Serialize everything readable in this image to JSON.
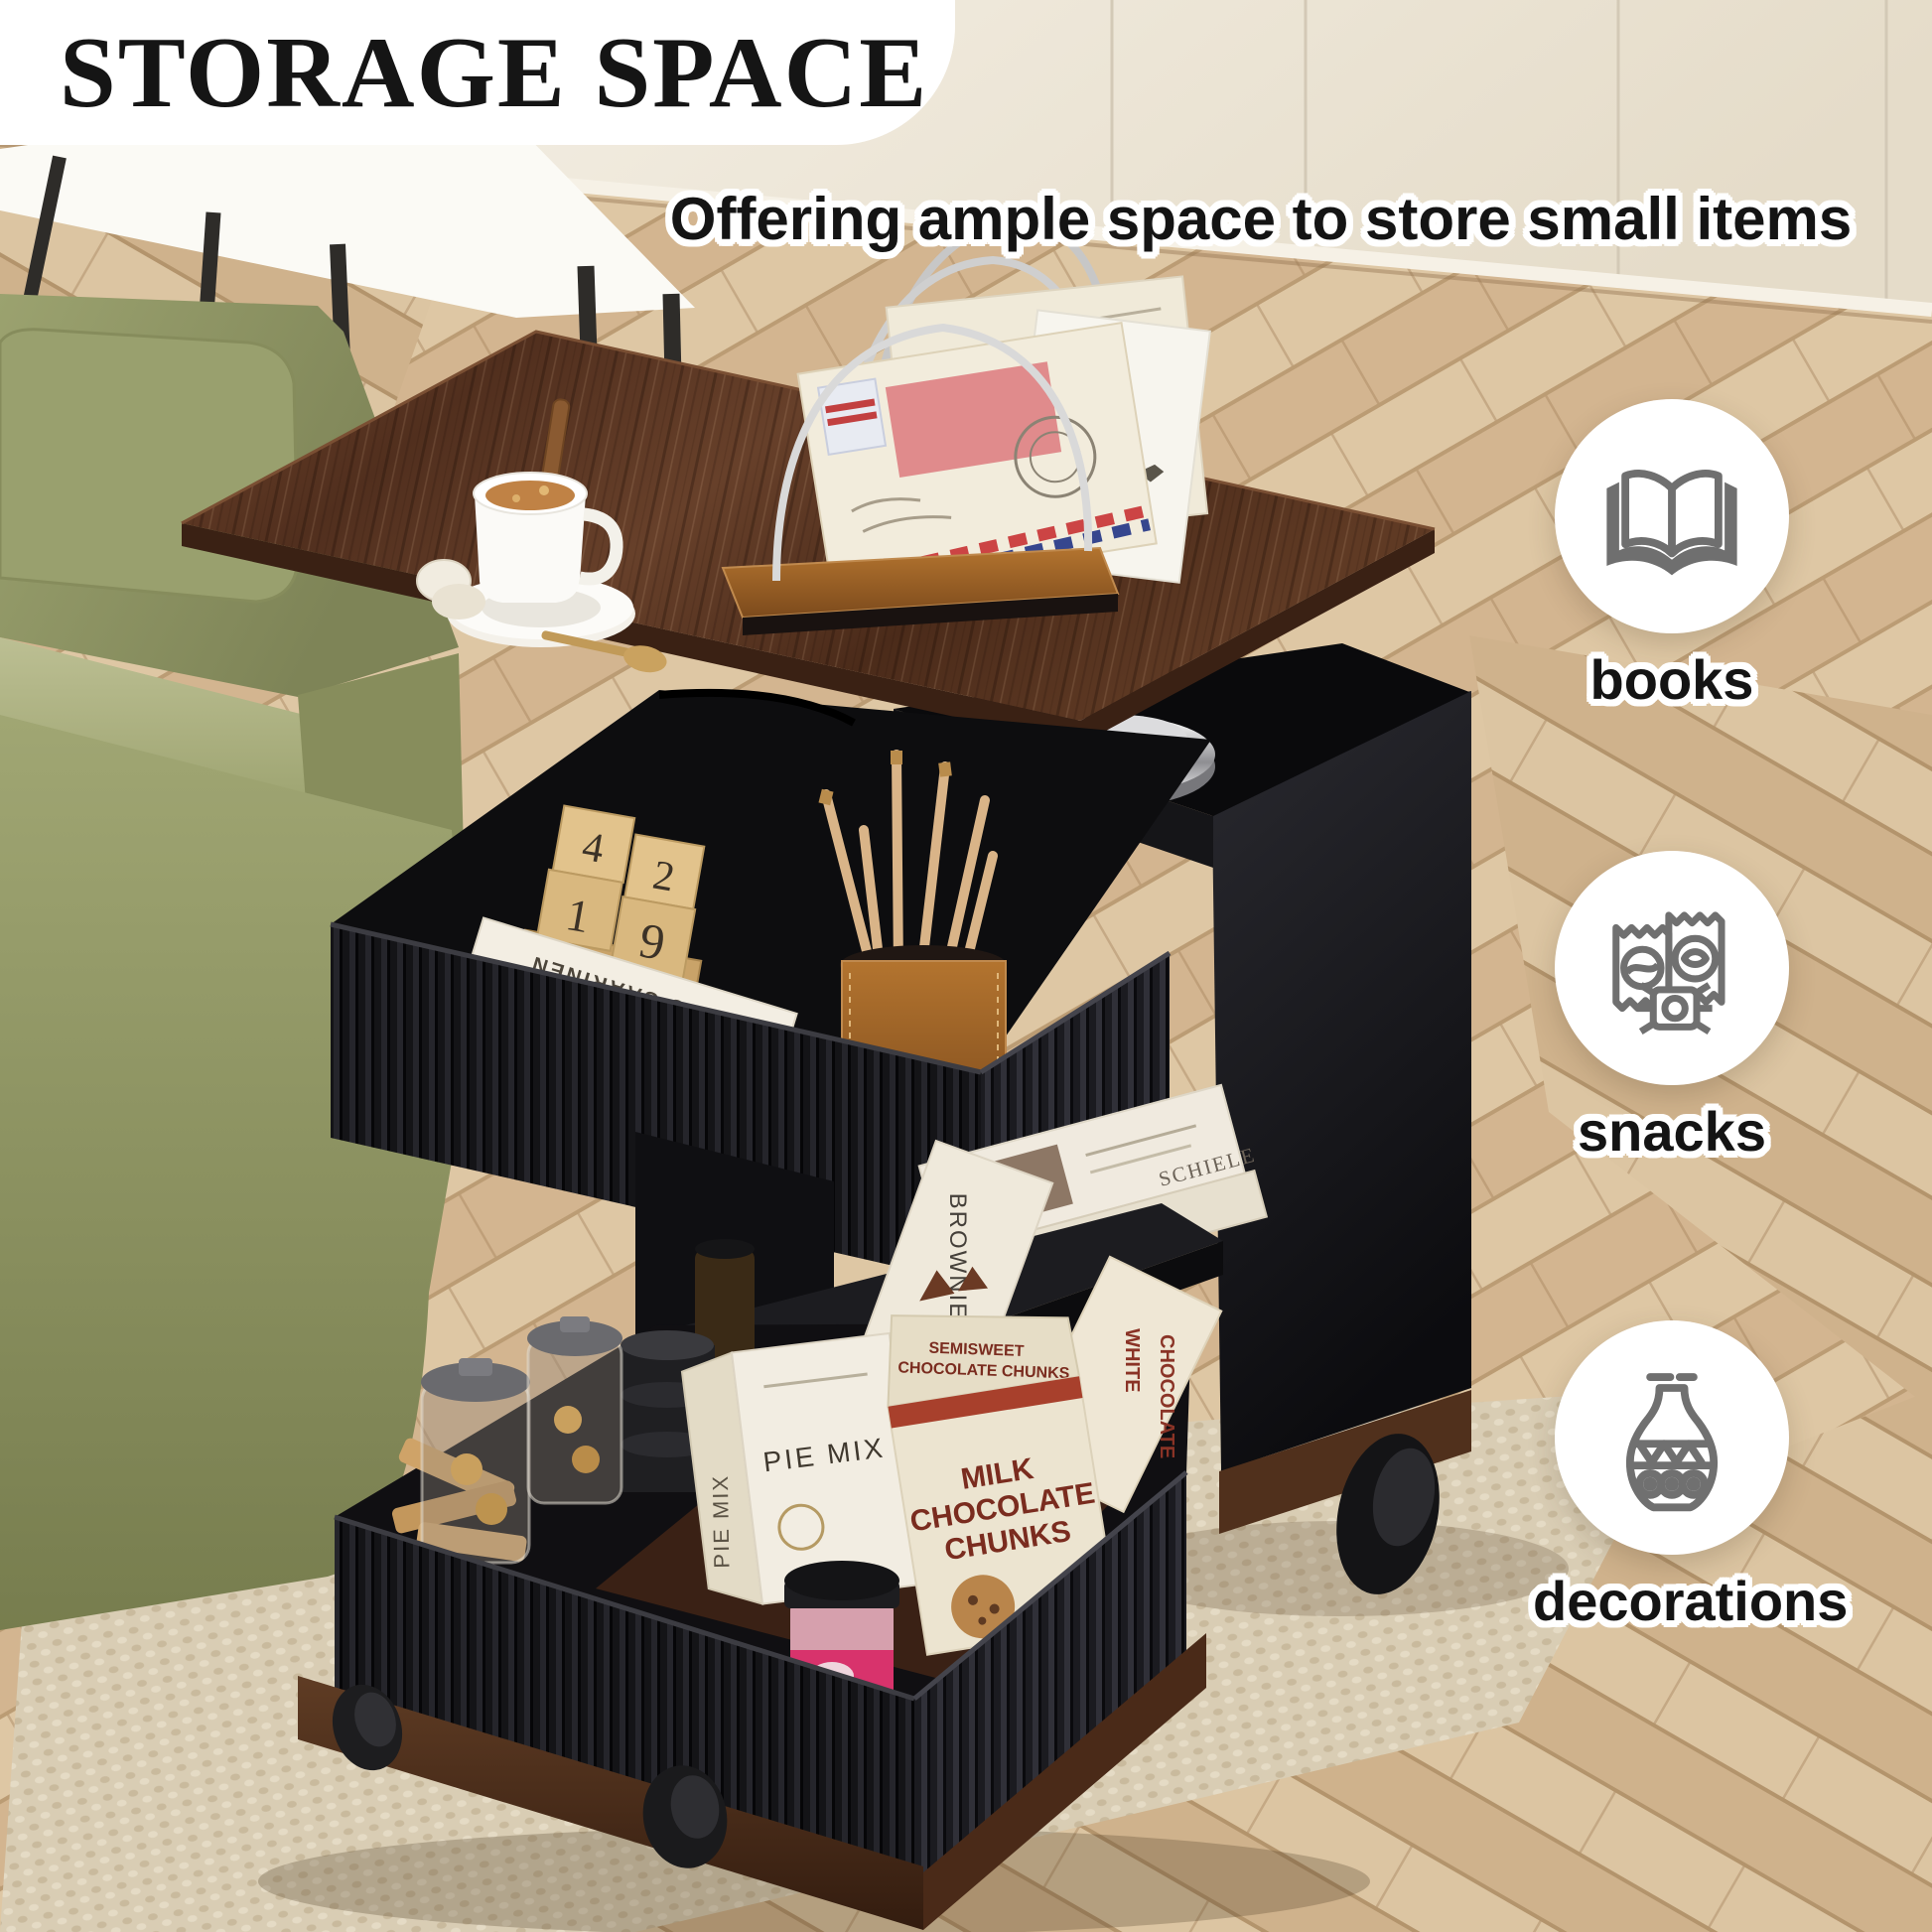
{
  "header": {
    "title": "STORAGE SPACE",
    "subtitle": "Offering ample space to store small items"
  },
  "features": [
    {
      "label": "books",
      "icon": "open-book-icon"
    },
    {
      "label": "snacks",
      "icon": "snack-packets-icon"
    },
    {
      "label": "decorations",
      "icon": "vase-icon"
    }
  ],
  "scene": {
    "product_texts": {
      "calendar_digits": [
        "1",
        "4",
        "2",
        "9"
      ],
      "calendar_month": "february",
      "book_spine_top": "EERO SAARINEN",
      "book_spine_author": "Peter Lindbergh",
      "shelf_book_spine": "SCHIELE",
      "pie_box_front": "PIE MIX",
      "pie_box_side": "PIE MIX",
      "brownie_box": "BROWNIE MIX",
      "chunks_flap_line1": "SEMISWEET",
      "chunks_flap_line2": "CHOCOLATE CHUNKS",
      "milk_box_line1": "MILK",
      "milk_box_line2": "CHOCOLATE",
      "milk_box_line3": "CHUNKS",
      "white_box_line1": "WHITE",
      "white_box_line2": "CHOCOLATE"
    }
  },
  "colors": {
    "title_text": "#151515",
    "panel_bg": "#ffffff",
    "icon_gray": "#6f6f6f",
    "wood_top": "#5a3526",
    "cabinet_black": "#17171a",
    "sofa_green": "#949a68",
    "rug_beige": "#d8ccb3",
    "floor_wood": "#d9c09e",
    "wall_cream": "#ece4d3",
    "base_walnut": "#4a2b18",
    "leather_brown": "#9c5a28",
    "chunks_text": "#7c2d20"
  }
}
